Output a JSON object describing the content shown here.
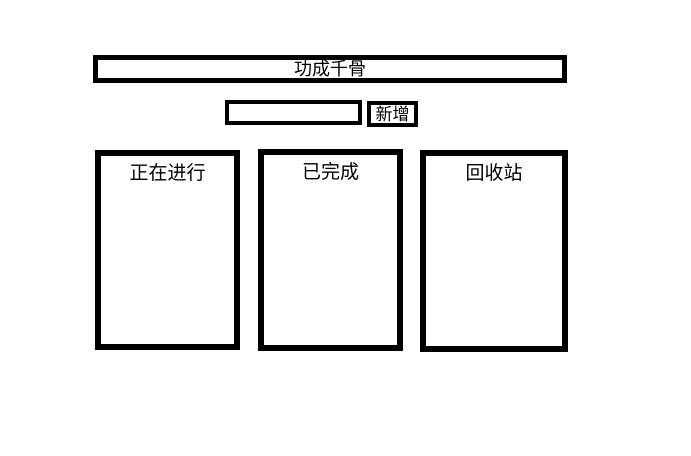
{
  "app": {
    "title": "功成千骨",
    "border_color": "#000000",
    "background_color": "#ffffff",
    "text_color": "#000000"
  },
  "toolbar": {
    "input_value": "",
    "input_placeholder": "",
    "add_button_label": "新增"
  },
  "panels": [
    {
      "label": "正在进行"
    },
    {
      "label": "已完成"
    },
    {
      "label": "回收站"
    }
  ]
}
